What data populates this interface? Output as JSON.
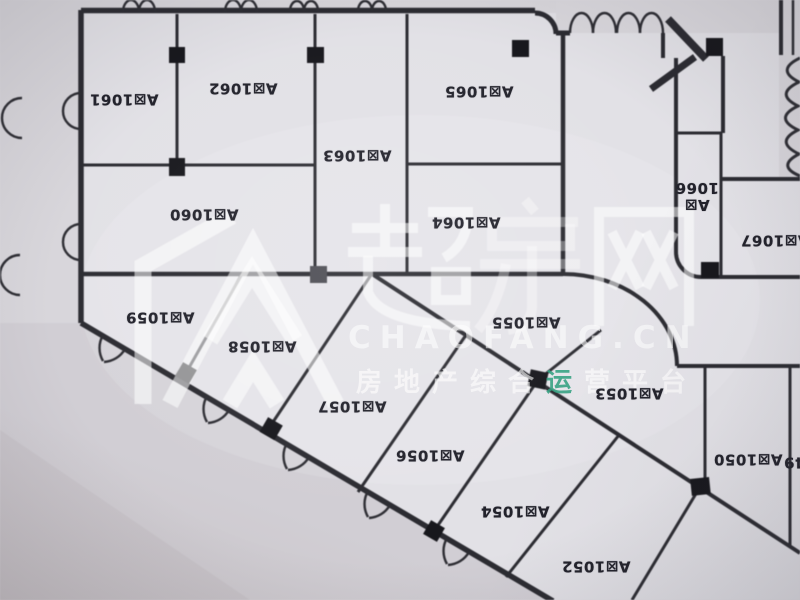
{
  "page": {
    "type": "floor-plan-photo",
    "building_zone": "A区"
  },
  "floor_plan": {
    "rooms": [
      {
        "label": "A区1061",
        "x": 124,
        "y": 99
      },
      {
        "label": "A区1062",
        "x": 243,
        "y": 88
      },
      {
        "label": "A区1063",
        "x": 357,
        "y": 155
      },
      {
        "label": "A区1065",
        "x": 479,
        "y": 91
      },
      {
        "label": "A区1066",
        "x": 697,
        "y": 196,
        "two_line": true
      },
      {
        "label": "A区1067",
        "x": 775,
        "y": 240
      },
      {
        "label": "A区1060",
        "x": 204,
        "y": 214
      },
      {
        "label": "A区1064",
        "x": 466,
        "y": 222
      },
      {
        "label": "A区1059",
        "x": 160,
        "y": 317
      },
      {
        "label": "A区1058",
        "x": 262,
        "y": 346
      },
      {
        "label": "A区1055",
        "x": 526,
        "y": 322
      },
      {
        "label": "A区1057",
        "x": 352,
        "y": 406
      },
      {
        "label": "A区1056",
        "x": 430,
        "y": 455
      },
      {
        "label": "A区1054",
        "x": 515,
        "y": 511
      },
      {
        "label": "A区1053",
        "x": 629,
        "y": 393
      },
      {
        "label": "A区1052",
        "x": 596,
        "y": 566
      },
      {
        "label": "A区1050",
        "x": 748,
        "y": 459
      },
      {
        "label": "A区1049",
        "x": 818,
        "y": 462
      }
    ]
  },
  "watermark": {
    "brand_name": "超房网",
    "domain": "CHAOFANG.CN",
    "tagline_full": "房地产综合运营平台",
    "tagline_pre": "房地产综合",
    "tagline_highlight": "运",
    "tagline_post": "营平台",
    "highlight_color": "#2f9e7d"
  }
}
